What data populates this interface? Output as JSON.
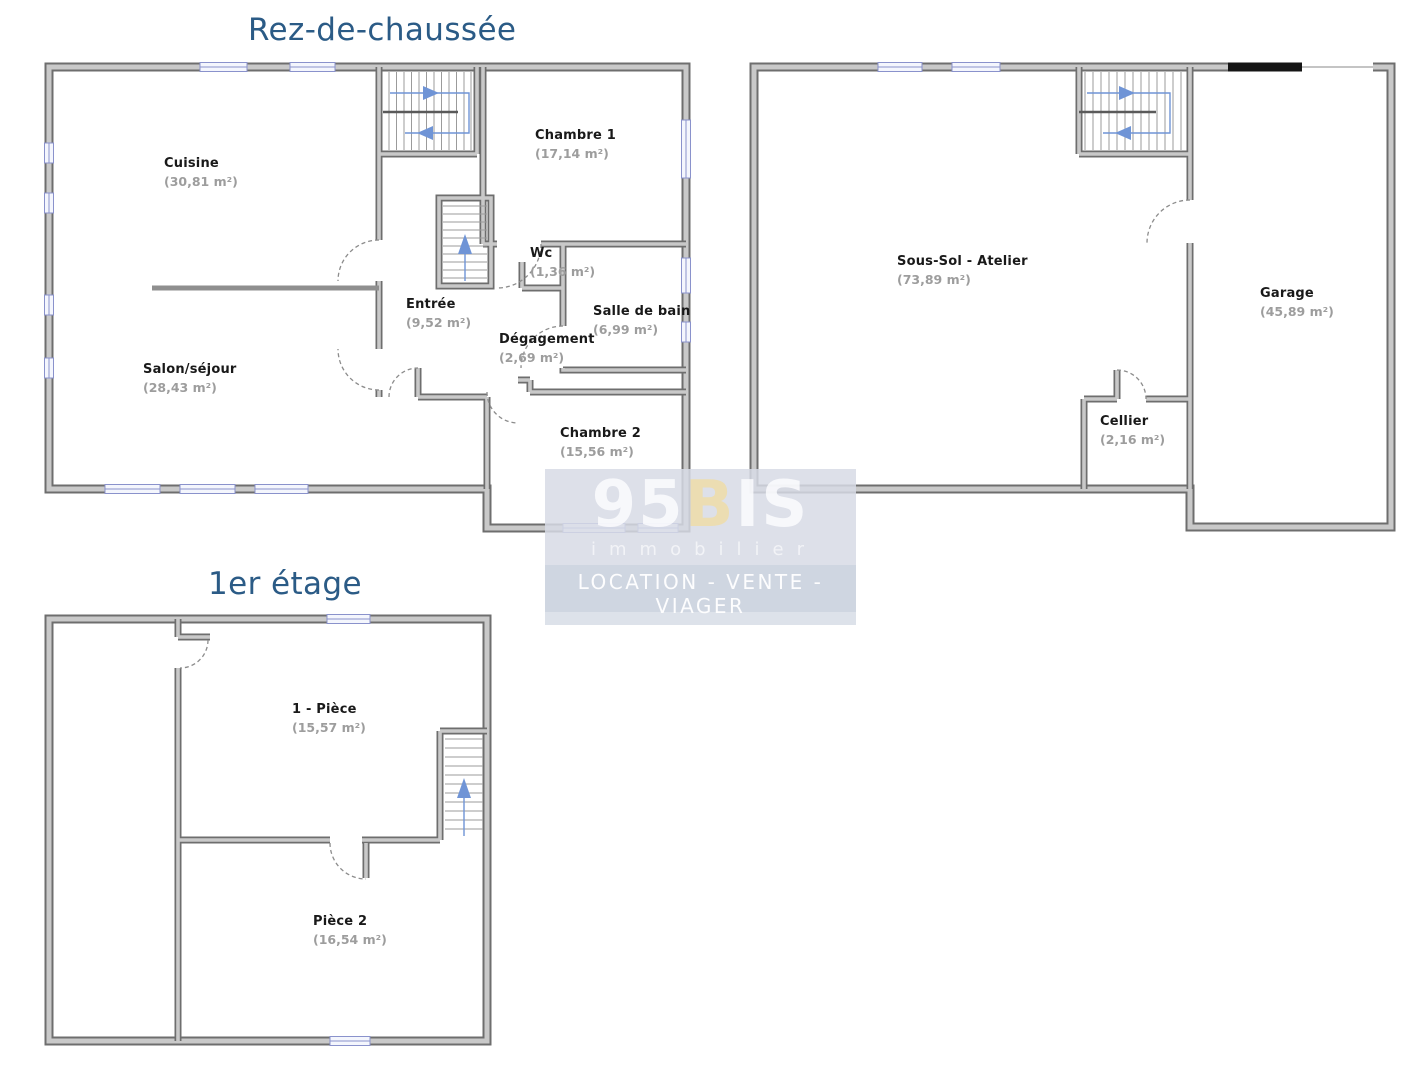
{
  "floors": {
    "ground": {
      "title": "Rez-de-chaussée",
      "rooms": [
        {
          "name": "Cuisine",
          "area": "(30,81 m²)"
        },
        {
          "name": "Chambre 1",
          "area": "(17,14 m²)"
        },
        {
          "name": "Wc",
          "area": "(1,36 m²)"
        },
        {
          "name": "Entrée",
          "area": "(9,52 m²)"
        },
        {
          "name": "Salle de bain",
          "area": "(6,99 m²)"
        },
        {
          "name": "Dégagement",
          "area": "(2,69 m²)"
        },
        {
          "name": "Salon/séjour",
          "area": "(28,43 m²)"
        },
        {
          "name": "Chambre 2",
          "area": "(15,56 m²)"
        }
      ]
    },
    "basement": {
      "rooms": [
        {
          "name": "Sous-Sol - Atelier",
          "area": "(73,89 m²)"
        },
        {
          "name": "Garage",
          "area": "(45,89 m²)"
        },
        {
          "name": "Cellier",
          "area": "(2,16 m²)"
        }
      ]
    },
    "first": {
      "title": "1er étage",
      "rooms": [
        {
          "name": "1 - Pièce",
          "area": "(15,57 m²)"
        },
        {
          "name": "Pièce 2",
          "area": "(16,54 m²)"
        }
      ]
    }
  },
  "watermark": {
    "brand_part1": "95",
    "brand_part2": "B",
    "brand_part3": "IS",
    "subtitle": "immobilier",
    "tagline": "LOCATION - VENTE - VIAGER"
  },
  "colors": {
    "title_blue": "#2b5b86",
    "wall_gray": "#c9c9c9",
    "wall_edge": "#6e6e6e",
    "window_blue": "#8a92cc",
    "stair_arrow_blue": "#6f94d6",
    "room_name": "#191919",
    "room_area": "#9d9d9d",
    "watermark_beige": "#ecdcaf"
  }
}
